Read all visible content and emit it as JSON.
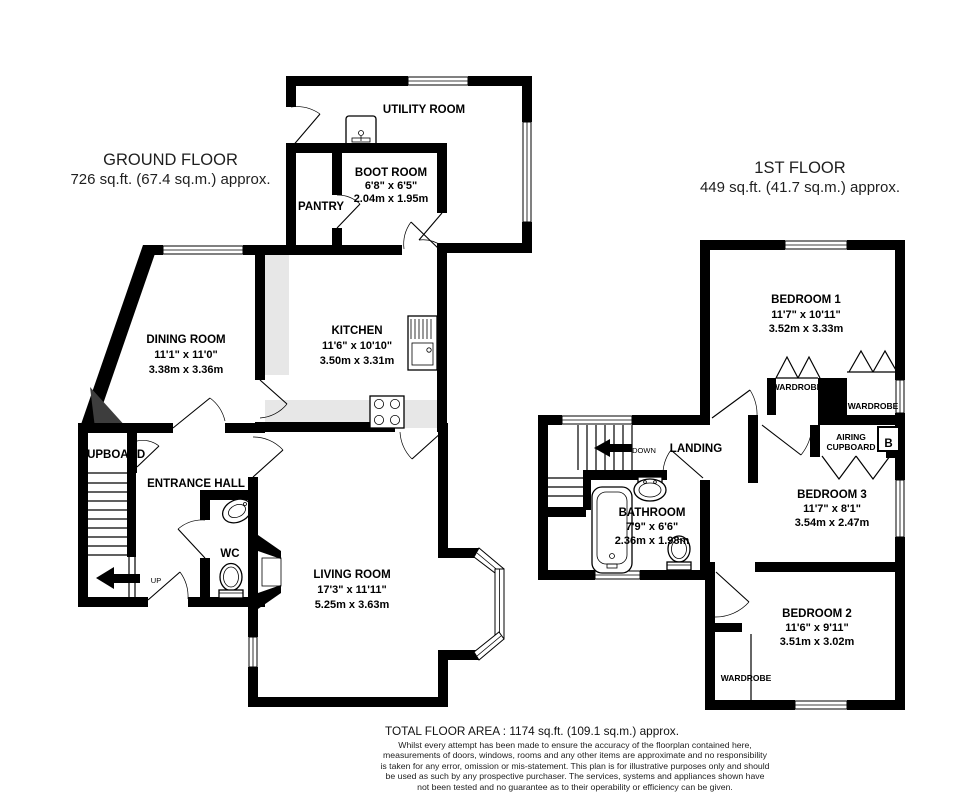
{
  "ground_floor": {
    "title": "GROUND FLOOR",
    "subtitle": "726 sq.ft. (67.4 sq.m.) approx.",
    "rooms": {
      "utility": {
        "name": "UTILITY ROOM"
      },
      "boot_room": {
        "name": "BOOT ROOM",
        "imperial": "6'8\" x 6'5\"",
        "metric": "2.04m x 1.95m"
      },
      "pantry": {
        "name": "PANTRY"
      },
      "kitchen": {
        "name": "KITCHEN",
        "imperial": "11'6\" x 10'10\"",
        "metric": "3.50m x 3.31m"
      },
      "dining_room": {
        "name": "DINING ROOM",
        "imperial": "11'1\" x 11'0\"",
        "metric": "3.38m x 3.36m"
      },
      "entrance_hall": {
        "name": "ENTRANCE HALL"
      },
      "cupboard": {
        "name": "CUPBOARD"
      },
      "wc": {
        "name": "WC"
      },
      "living_room": {
        "name": "LIVING ROOM",
        "imperial": "17'3\" x 11'11\"",
        "metric": "5.25m x 3.63m"
      }
    },
    "stairs_label": "UP"
  },
  "first_floor": {
    "title": "1ST FLOOR",
    "subtitle": "449 sq.ft. (41.7 sq.m.) approx.",
    "rooms": {
      "bedroom1": {
        "name": "BEDROOM 1",
        "imperial": "11'7\" x 10'11\"",
        "metric": "3.52m x 3.33m"
      },
      "bedroom2": {
        "name": "BEDROOM 2",
        "imperial": "11'6\" x 9'11\"",
        "metric": "3.51m x 3.02m"
      },
      "bedroom3": {
        "name": "BEDROOM 3",
        "imperial": "11'7\" x 8'1\"",
        "metric": "3.54m x 2.47m"
      },
      "bathroom": {
        "name": "BATHROOM",
        "imperial": "7'9\" x 6'6\"",
        "metric": "2.36m x 1.98m"
      },
      "landing": {
        "name": "LANDING"
      },
      "wardrobe_left": {
        "name": "WARDROBE"
      },
      "wardrobe_right": {
        "name": "WARDROBE"
      },
      "wardrobe_bedroom2": {
        "name": "WARDROBE"
      },
      "airing_cupboard": {
        "line1": "AIRING",
        "line2": "CUPBOARD"
      },
      "boiler": "B"
    },
    "stairs_label": "DOWN"
  },
  "footer": {
    "total_area": "TOTAL FLOOR AREA : 1174 sq.ft. (109.1 sq.m.) approx.",
    "disclaimer": "Whilst every attempt has been made to ensure the accuracy of the floorplan contained here, measurements of doors, windows, rooms and any other items are approximate and no responsibility is taken for any error, omission or mis-statement. This plan is for illustrative purposes only and should be used as such by any prospective purchaser. The services, systems and appliances shown have not been tested and no guarantee as to their operability or efficiency can be given.",
    "credit": "Made with Metropix ©2025"
  },
  "colors": {
    "wall": "#000000",
    "counter": "#e7e7e7",
    "chimney": "#3d3d3d"
  }
}
